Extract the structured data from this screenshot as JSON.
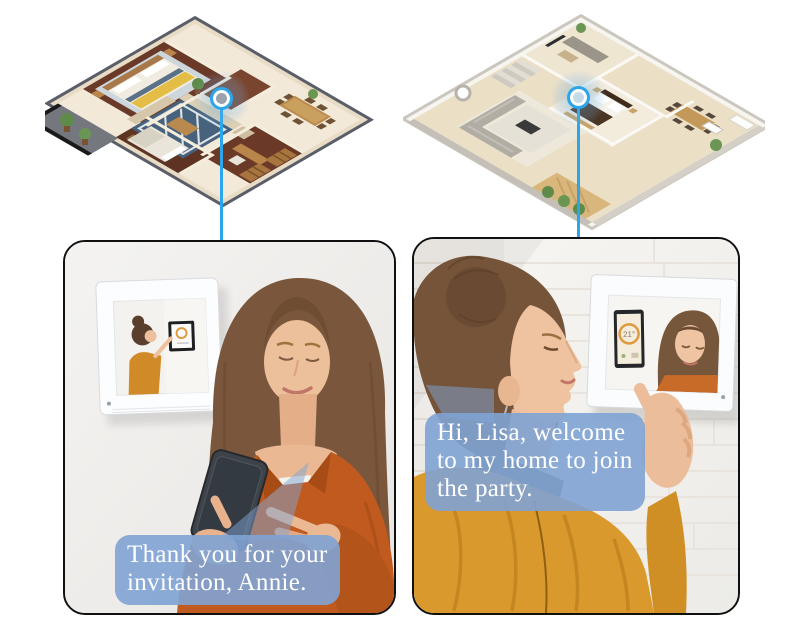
{
  "graphic_title": "video-intercom-connecting-two-homes",
  "bubbles": {
    "left": "Thank you for your\ninvitation, Annie.",
    "right": "Hi, Lisa,  welcome\nto my home to  join\nthe party."
  },
  "panel_right": {
    "thermostat": "21°"
  },
  "colors": {
    "accent_blue": "#2BA6EA",
    "bubble_blue": "rgba(127,163,212,0.9)",
    "shirt_orange": "#C05A1E",
    "jacket_mustard": "#D9992C",
    "plan_left_wood": "#6B3927",
    "plan_right_wood": "#EBDFC6"
  },
  "markers": {
    "left": "intercom-location-left-home",
    "right": "intercom-location-right-home"
  }
}
